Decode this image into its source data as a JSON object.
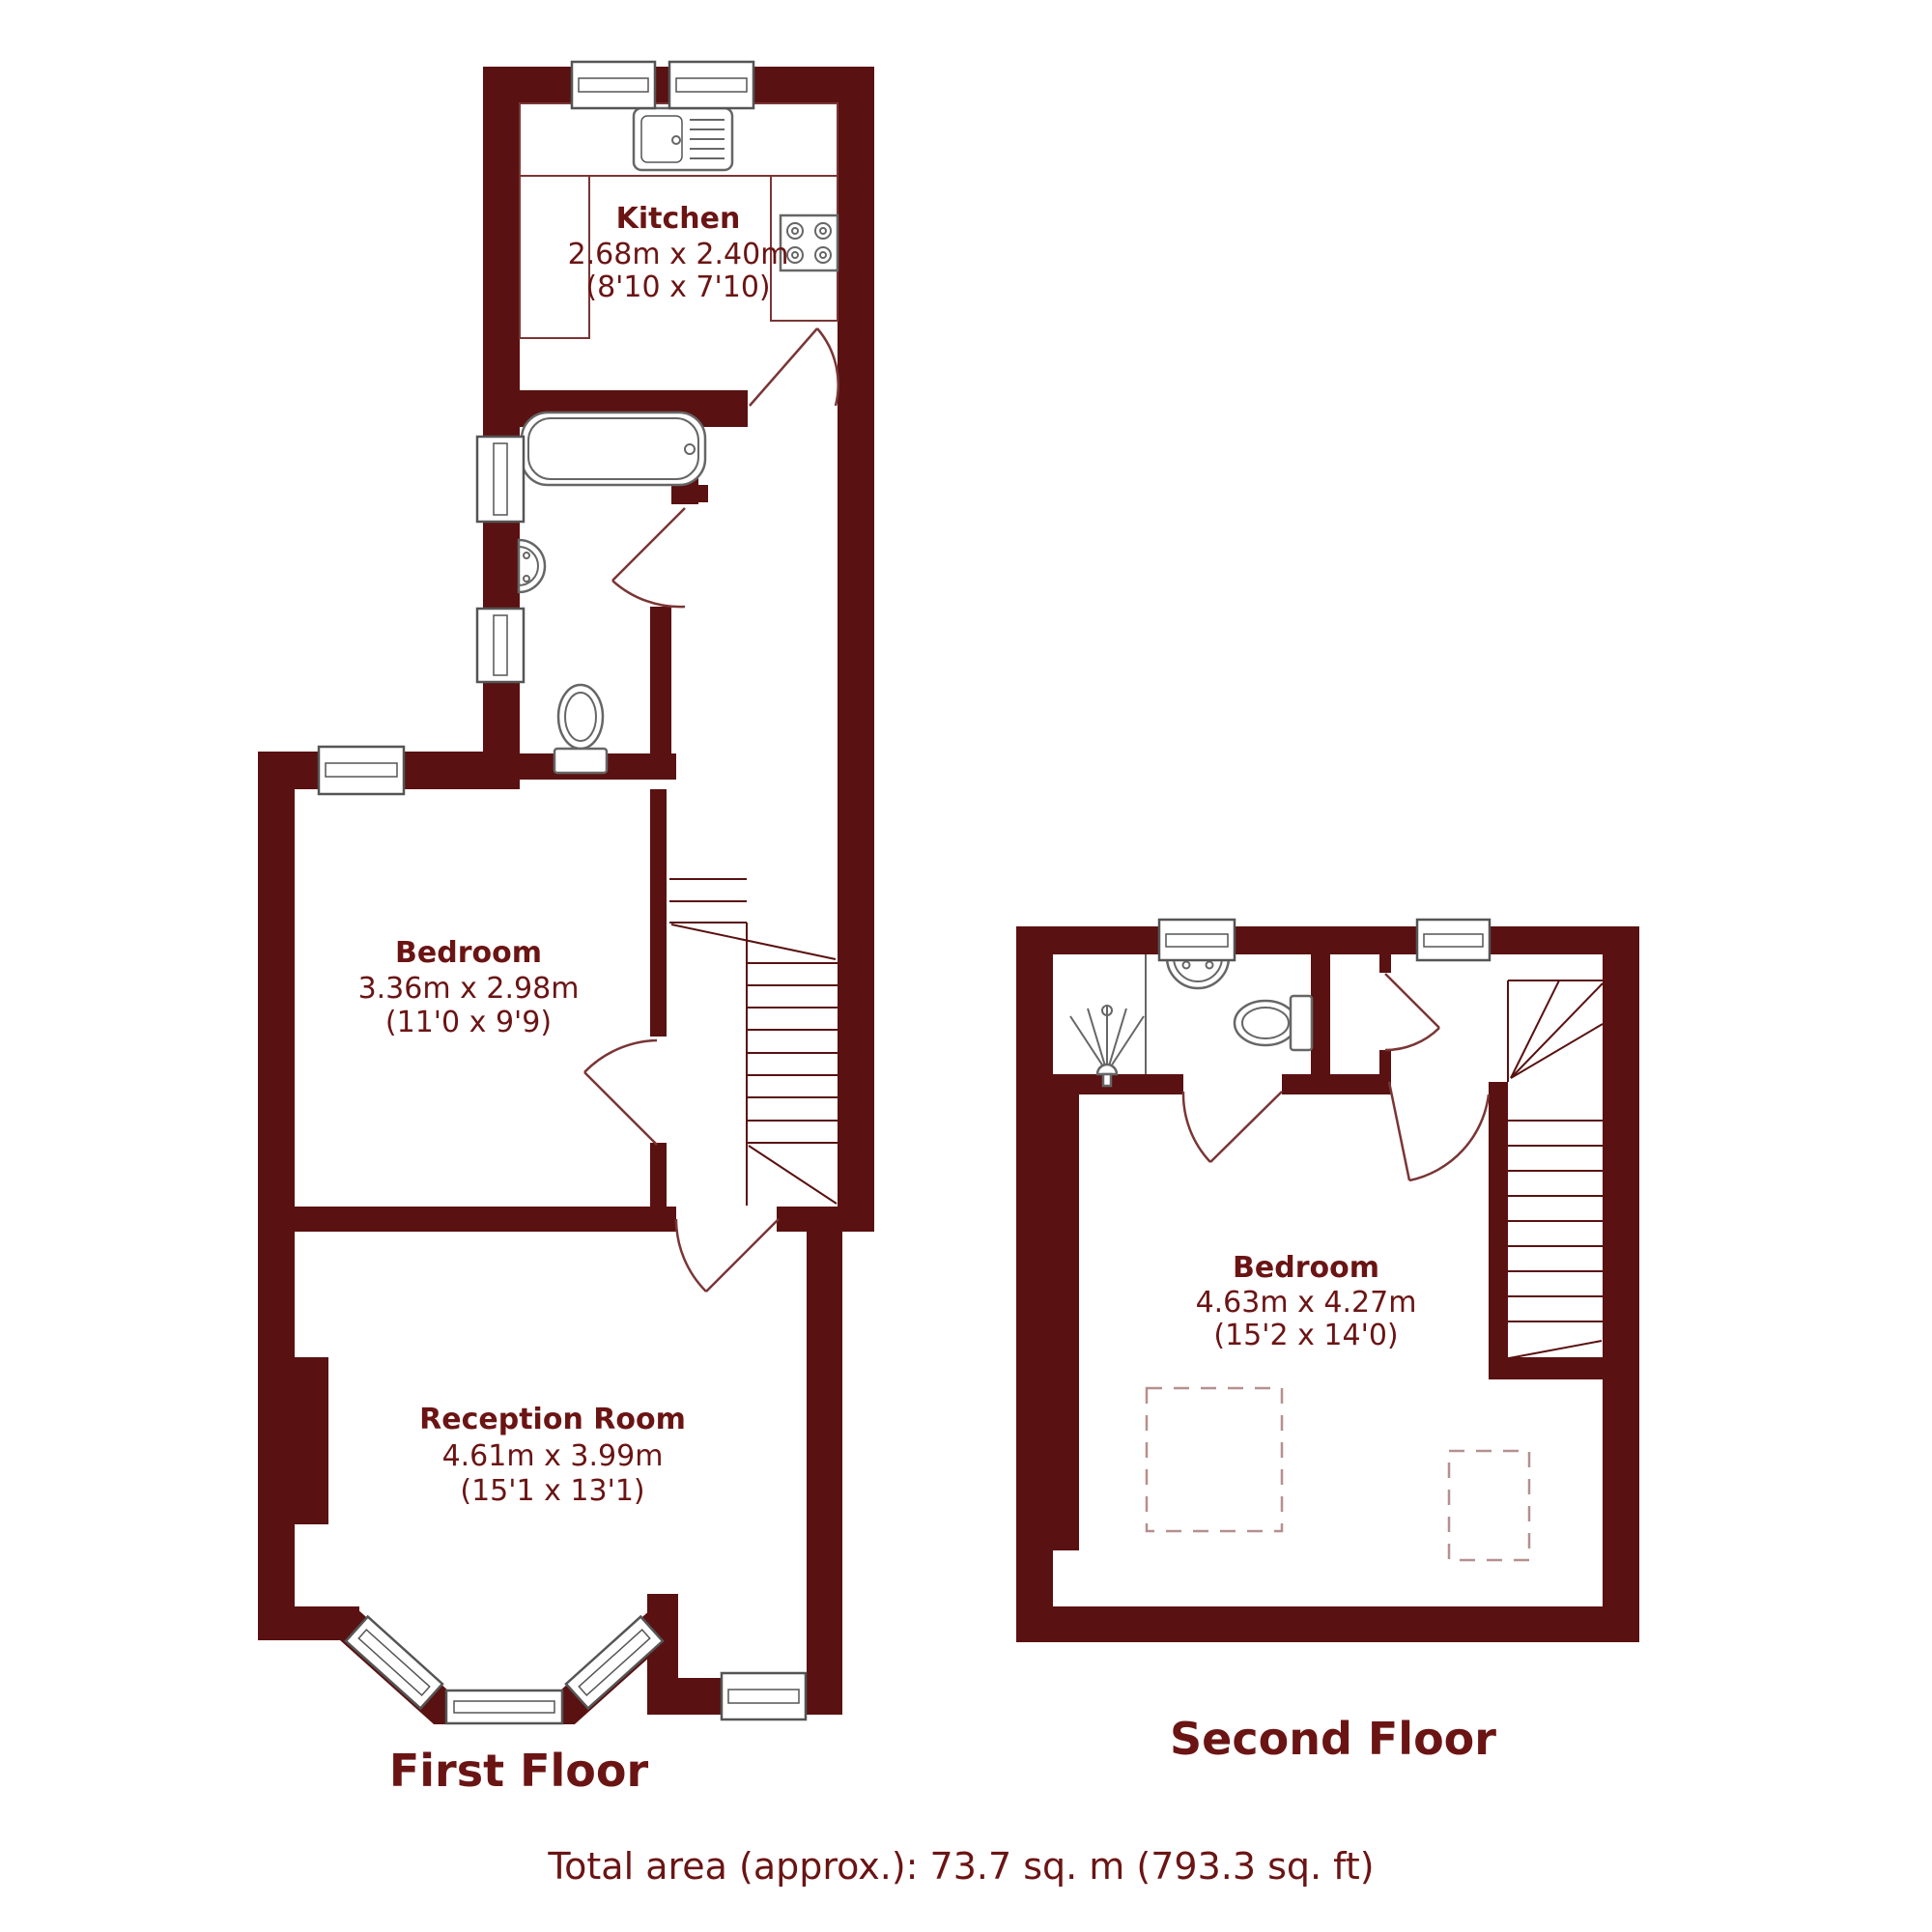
{
  "document_type": "property-floorplan",
  "footer": {
    "total_area": "Total area (approx.): 73.7 sq. m (793.3 sq. ft)"
  },
  "floors": [
    {
      "name": "First Floor",
      "rooms": [
        {
          "name": "Kitchen",
          "metric": "2.68m x 2.40m",
          "imperial": "(8'10 x 7'10)"
        },
        {
          "name": "Bedroom",
          "metric": "3.36m x 2.98m",
          "imperial": "(11'0 x 9'9)"
        },
        {
          "name": "Reception Room",
          "metric": "4.61m x 3.99m",
          "imperial": "(15'1 x 13'1)"
        }
      ],
      "fixtures": [
        "kitchen-sink",
        "hob",
        "bathtub",
        "washbasin",
        "toilet",
        "staircase",
        "bay-window"
      ]
    },
    {
      "name": "Second Floor",
      "rooms": [
        {
          "name": "Bedroom",
          "metric": "4.63m x 4.27m",
          "imperial": "(15'2 x 14'0)"
        }
      ],
      "fixtures": [
        "shower",
        "washbasin",
        "toilet",
        "staircase"
      ]
    }
  ],
  "colors": {
    "wall": "#5a1111",
    "label": "#6b1414",
    "fixture": "#666666",
    "line": "#7a3535",
    "dashed": "#b59090",
    "background": "#ffffff"
  }
}
